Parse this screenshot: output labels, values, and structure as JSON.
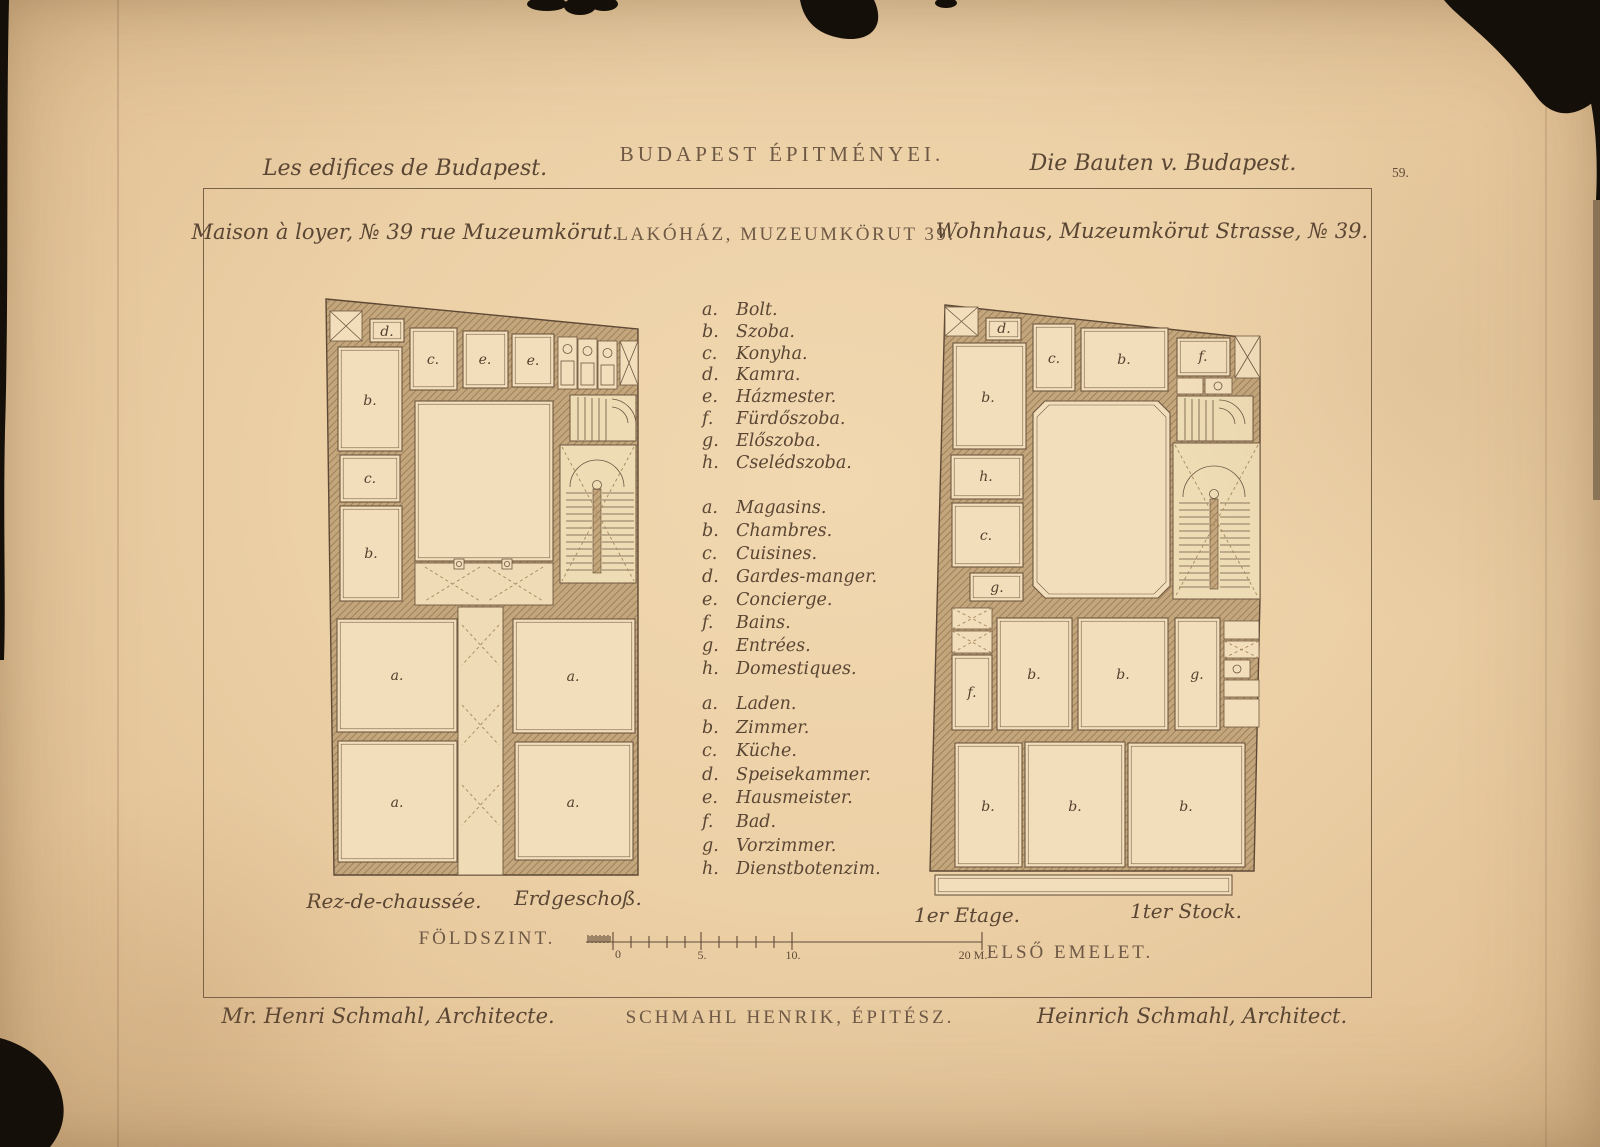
{
  "page": {
    "number": "59."
  },
  "titles": {
    "french": "Les edifices de Budapest.",
    "hungarian": "BUDAPEST ÉPITMÉNYEI.",
    "german": "Die Bauten v. Budapest."
  },
  "subtitles": {
    "french": "Maison à loyer, № 39 rue Muzeumkörut.",
    "hungarian": "LAKÓHÁZ, MUZEUMKÖRUT 39.",
    "german": "Wohnhaus, Muzeumkörut Strasse, № 39."
  },
  "legend": {
    "hungarian": [
      {
        "key": "a.",
        "label": "Bolt."
      },
      {
        "key": "b.",
        "label": "Szoba."
      },
      {
        "key": "c.",
        "label": "Konyha."
      },
      {
        "key": "d.",
        "label": "Kamra."
      },
      {
        "key": "e.",
        "label": "Házmester."
      },
      {
        "key": "f.",
        "label": "Fürdőszoba."
      },
      {
        "key": "g.",
        "label": "Előszoba."
      },
      {
        "key": "h.",
        "label": "Cselédszoba."
      }
    ],
    "french": [
      {
        "key": "a.",
        "label": "Magasins."
      },
      {
        "key": "b.",
        "label": "Chambres."
      },
      {
        "key": "c.",
        "label": "Cuisines."
      },
      {
        "key": "d.",
        "label": "Gardes-manger."
      },
      {
        "key": "e.",
        "label": "Concierge."
      },
      {
        "key": "f.",
        "label": "Bains."
      },
      {
        "key": "g.",
        "label": "Entrées."
      },
      {
        "key": "h.",
        "label": "Domestiques."
      }
    ],
    "german": [
      {
        "key": "a.",
        "label": "Laden."
      },
      {
        "key": "b.",
        "label": "Zimmer."
      },
      {
        "key": "c.",
        "label": "Küche."
      },
      {
        "key": "d.",
        "label": "Speisekammer."
      },
      {
        "key": "e.",
        "label": "Hausmeister."
      },
      {
        "key": "f.",
        "label": "Bad."
      },
      {
        "key": "g.",
        "label": "Vorzimmer."
      },
      {
        "key": "h.",
        "label": "Dienstbotenzim."
      }
    ]
  },
  "plans": {
    "ground": {
      "caption_french": "Rez-de-chaussée.",
      "caption_german": "Erdgeschoß.",
      "caption_hungarian": "FÖLDSZINT.",
      "room_labels": [
        "d.",
        "b.",
        "c.",
        "b.",
        "c.",
        "e.",
        "e.",
        "a.",
        "a.",
        "a.",
        "a."
      ]
    },
    "first": {
      "caption_french": "1er Etage.",
      "caption_german": "1ter Stock.",
      "caption_hungarian": "ELSŐ EMELET.",
      "room_labels": [
        "d.",
        "b.",
        "h.",
        "c.",
        "g.",
        "c.",
        "b.",
        "f.",
        "f.",
        "b.",
        "b.",
        "g.",
        "b.",
        "b.",
        "b."
      ]
    }
  },
  "scale_bar": {
    "labels": [
      "0",
      "5.",
      "10.",
      "20 M."
    ]
  },
  "credits": {
    "french": "Mr. Henri Schmahl, Architecte.",
    "hungarian": "SCHMAHL HENRIK, ÉPITÉSZ.",
    "german": "Heinrich Schmahl, Architect."
  },
  "colors": {
    "paper": "#ecd0a6",
    "ink": "#5a4634",
    "wall": "#c3a67c",
    "tear": "#140f08"
  }
}
